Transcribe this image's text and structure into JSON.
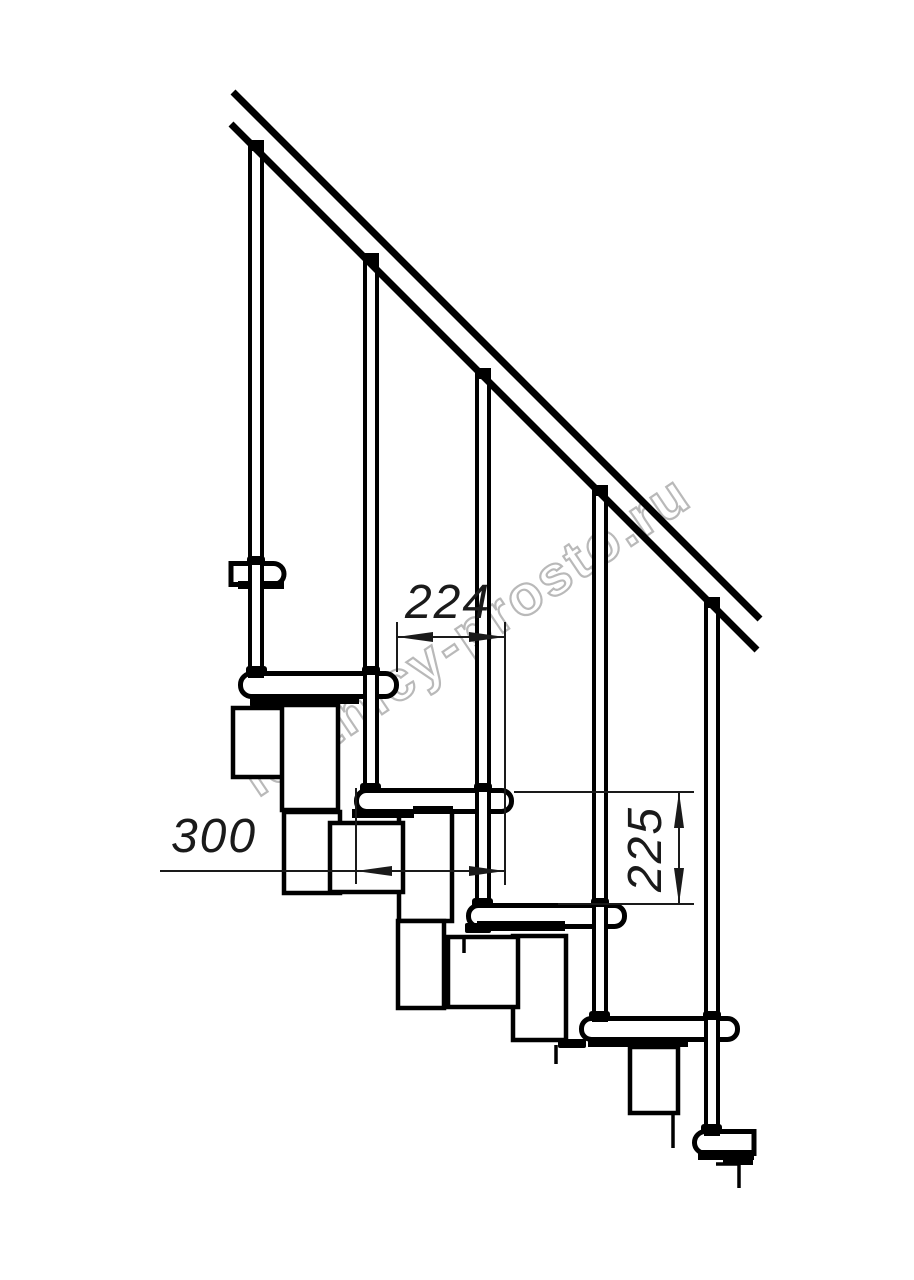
{
  "drawing": {
    "type": "technical side-view drawing of a modular staircase with handrail",
    "watermark": {
      "text": "lestnicy-prosto.ru"
    },
    "dimensions": {
      "step_run": {
        "value": "224",
        "orientation": "horizontal"
      },
      "tread_depth": {
        "value": "300",
        "orientation": "horizontal"
      },
      "riser_height": {
        "value": "225",
        "orientation": "vertical"
      }
    },
    "counts": {
      "balusters": 5,
      "treads": 6
    },
    "colors": {
      "line": "#000000",
      "background": "#ffffff",
      "watermark_outline": "#b2b2b2"
    }
  }
}
